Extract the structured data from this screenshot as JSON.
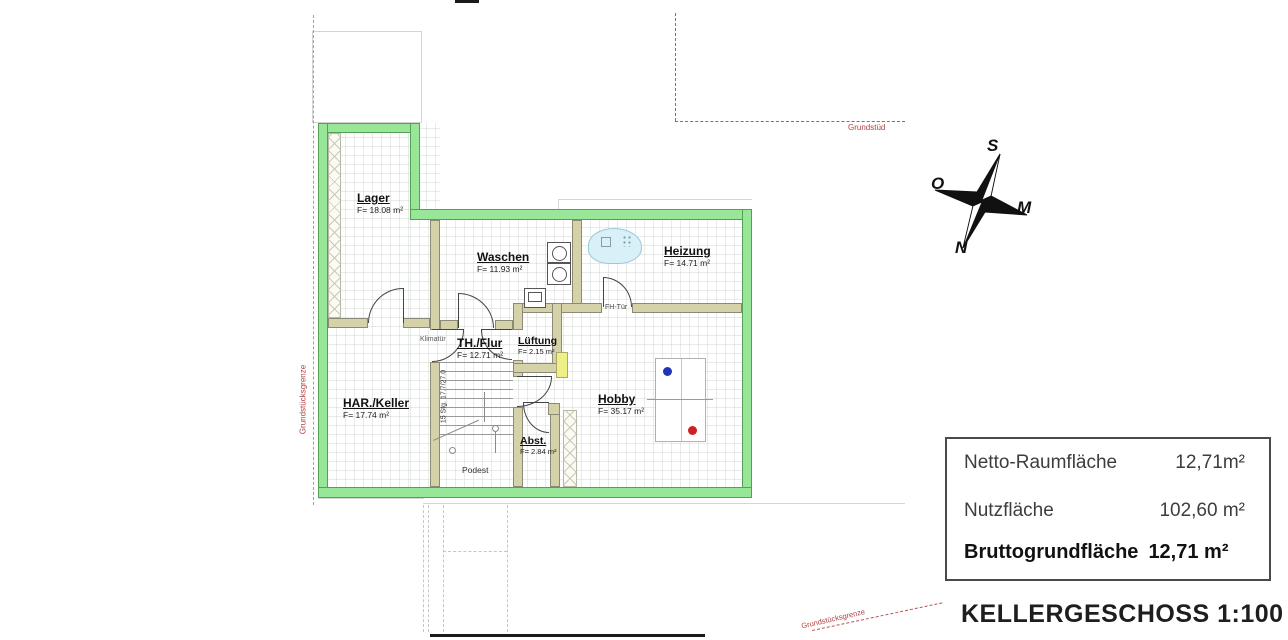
{
  "title": "KELLERGESCHOSS 1:100",
  "plan": {
    "rooms": [
      {
        "name": "Lager",
        "area": "F= 18.08 m²"
      },
      {
        "name": "Waschen",
        "area": "F= 11.93 m²"
      },
      {
        "name": "Heizung",
        "area": "F= 14.71 m²"
      },
      {
        "name": "TH./Flur",
        "area": "F= 12.71 m²"
      },
      {
        "name": "Lüftung",
        "area": "F= 2.15 m²"
      },
      {
        "name": "HAR./Keller",
        "area": "F= 17.74 m²"
      },
      {
        "name": "Hobby",
        "area": "F= 35.17 m²"
      },
      {
        "name": "Abst.",
        "area": "F= 2.84 m²"
      }
    ],
    "annotations": {
      "klimatuer": "Klimatür",
      "fh_tuer": "FH-Tür",
      "podest": "Podest",
      "stairs": "15 Stg. 17.7/27.0"
    },
    "boundaries": {
      "left": "Grundstücksgrenze",
      "top_right": "Grundstüd",
      "bottom": "Grundstücksgrenze"
    }
  },
  "compass": {
    "top": "S",
    "left": "O",
    "right": "M",
    "bottom": "N"
  },
  "legend": {
    "rows": [
      {
        "label": "Netto-Raumfläche",
        "value": "12,71m²"
      },
      {
        "label": "Nutzfläche",
        "value": "102,60 m²"
      },
      {
        "label": "Bruttogrundfläche",
        "value": "12,71 m²"
      }
    ]
  },
  "colors": {
    "outer_wall_green": "#98e698",
    "inner_wall_tan": "#d5d1a8",
    "boundary_red": "#b04040",
    "table_dot_blue": "#2233bb",
    "table_dot_red": "#cc2222",
    "vent_marker_yellow": "#eef086",
    "heater_cloud_blue": "#d8f0f8"
  }
}
